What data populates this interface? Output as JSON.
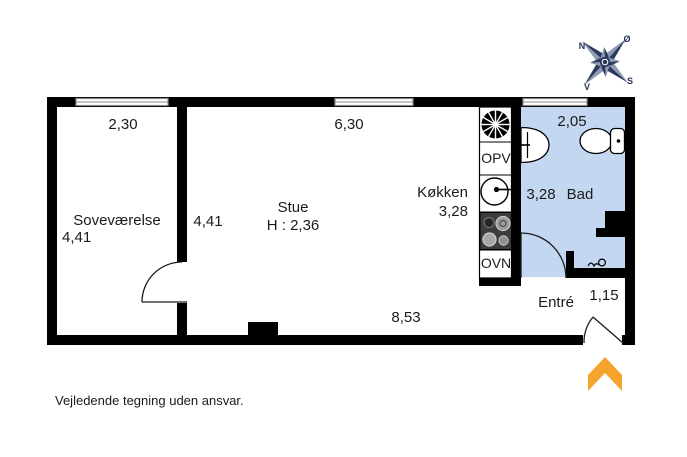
{
  "floorplan": {
    "rooms": {
      "sovevaerelse": {
        "name": "Soveværelse",
        "width": "2,30",
        "depth": "4,41"
      },
      "stue": {
        "name": "Stue",
        "ceiling_height": "H : 2,36",
        "window_width": "6,30",
        "depth": "4,41",
        "length": "8,53"
      },
      "koekken": {
        "name": "Køkken",
        "depth": "3,28"
      },
      "bad": {
        "name": "Bad",
        "window_width": "2,05",
        "depth": "3,28"
      },
      "entre": {
        "name": "Entré",
        "door_width": "1,15"
      }
    },
    "appliances": {
      "dishwasher": "OPV",
      "oven": "OVN"
    },
    "compass": {
      "north": "N",
      "east": "Ø",
      "south": "S",
      "west": "V"
    },
    "colors": {
      "wall": "#000000",
      "bath_floor": "#c3d7f1",
      "entrance_arrow": "#f5a42b",
      "compass_dark": "#2b3a5c",
      "compass_light": "#8f9ab3"
    }
  },
  "footer": {
    "disclaimer": "Vejledende tegning uden ansvar."
  }
}
